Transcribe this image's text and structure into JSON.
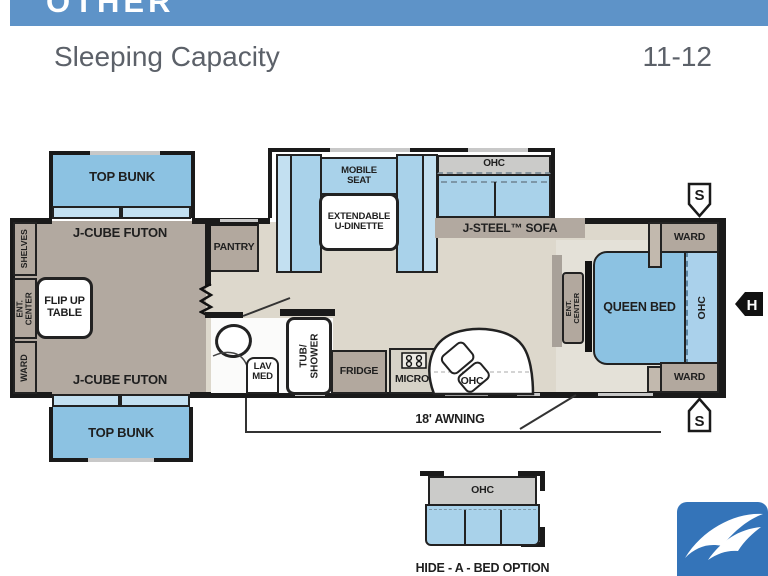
{
  "header": {
    "category": "OTHER",
    "spec_label": "Sleeping Capacity",
    "spec_value": "11-12"
  },
  "colors": {
    "header_blue": "#5E93C8",
    "furniture_blue": "#8CC2E2",
    "furniture_blue_light": "#C3E0F1",
    "cabinet_tan": "#B2A89E",
    "floor_taupe": "#B2A9A0",
    "floor_beige": "#DDD8CC",
    "ohc_gray": "#CBCBC9",
    "wall_black": "#1A1A1A",
    "logo_blue": "#3474B9",
    "header_text_gray": "#5C6169"
  },
  "plan": {
    "bunk_front": "TOP BUNK",
    "futon_front": "J-CUBE FUTON",
    "bunk_rear": "TOP BUNK",
    "futon_rear": "J-CUBE FUTON",
    "shelves": "SHELVES",
    "ent_center_left": "ENT. CENTER",
    "ward_left": "WARD",
    "flip_table": "FLIP UP\nTABLE",
    "pantry": "PANTRY",
    "mobile_seat": "MOBILE\nSEAT",
    "dinette_table": "EXTENDABLE\nU-DINETTE",
    "sofa_ohc": "OHC",
    "sofa": "J-STEEL™ SOFA",
    "tub_shower": "TUB/\nSHOWER",
    "lav_med": "LAV\nMED",
    "fridge": "FRIDGE",
    "micro": "MICRO",
    "kitchen_ohc": "OHC",
    "ent_center_bedroom": "ENT. CENTER",
    "queen_bed": "QUEEN BED",
    "bed_ohc": "OHC",
    "ward_top": "WARD",
    "ward_bottom": "WARD",
    "speaker_top": "S",
    "speaker_bottom": "S",
    "hitch": "H",
    "awning": "18' AWNING",
    "inset_ohc": "OHC",
    "inset_caption": "HIDE - A - BED OPTION"
  }
}
